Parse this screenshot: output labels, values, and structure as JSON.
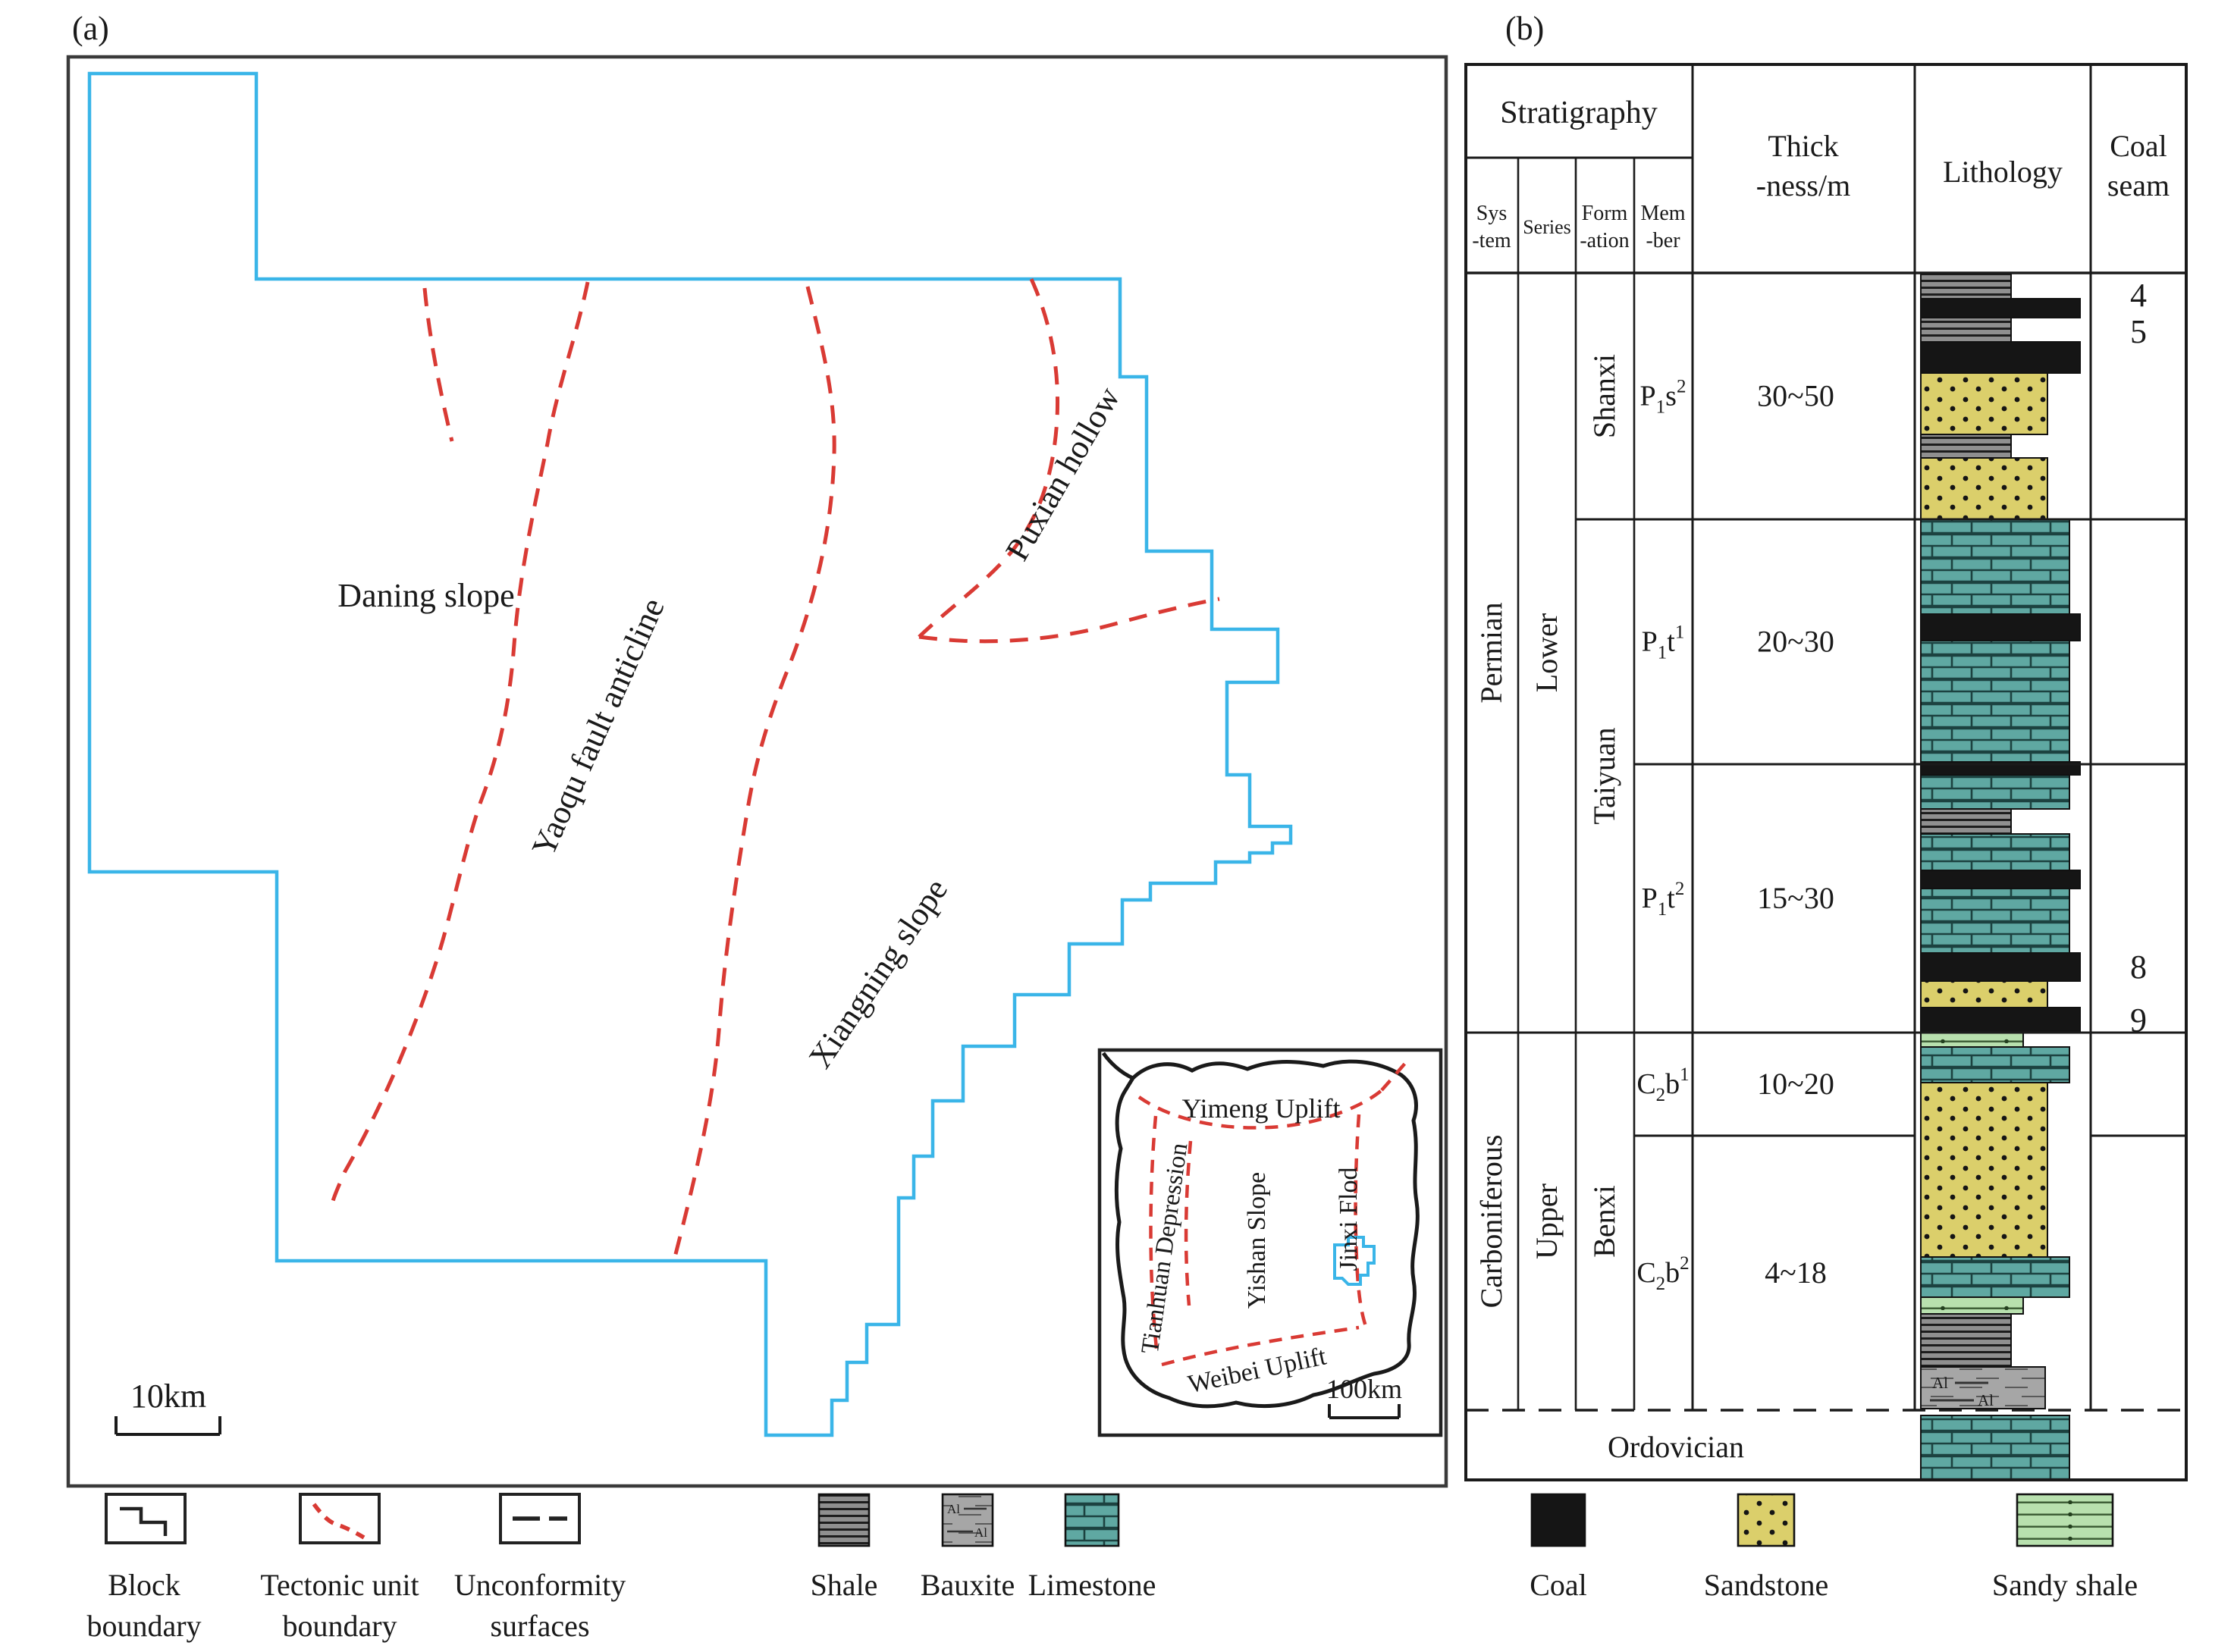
{
  "colors": {
    "block_boundary_blue": "#3AB5E8",
    "tectonic_red": "#D93A34",
    "limestone_teal": "#5FA8A2",
    "sandstone_yellow": "#DBCF6B",
    "sandy_shale_green": "#B8E0AE",
    "bauxite_gray": "#A6A6A6",
    "shale_gray": "#8F8F8F",
    "coal_black": "#151515",
    "line_black": "#1A1A1A"
  },
  "panel_a": {
    "label": "(a)",
    "region_labels": [
      {
        "name": "daning-slope",
        "text": "Daning slope",
        "x": 562,
        "y": 800,
        "rotate": 0,
        "size": 44
      },
      {
        "name": "yaoqu-fault-anticline",
        "text": "Yaoqu fault anticline",
        "x": 802,
        "y": 965,
        "rotate": -66,
        "size": 44
      },
      {
        "name": "puxian-hollow",
        "text": "Puxian hollow",
        "x": 1414,
        "y": 632,
        "rotate": -60,
        "size": 44
      },
      {
        "name": "xiangning-slope",
        "text": "Xiangning slope",
        "x": 1170,
        "y": 1292,
        "rotate": -56,
        "size": 44
      }
    ],
    "scale_bar": {
      "label": "10km"
    },
    "inset": {
      "labels": [
        {
          "name": "yimeng-uplift",
          "text": "Yimeng Uplift",
          "x": 1663,
          "y": 1474,
          "rotate": 0,
          "size": 36
        },
        {
          "name": "tianhuan-depression",
          "text": "Tianhuan Depression",
          "x": 1546,
          "y": 1648,
          "rotate": -82,
          "size": 33
        },
        {
          "name": "yishan-slope",
          "text": "Yishan Slope",
          "x": 1668,
          "y": 1636,
          "rotate": -90,
          "size": 34
        },
        {
          "name": "jinxi-flod",
          "text": "Jinxi Flod",
          "x": 1789,
          "y": 1608,
          "rotate": -90,
          "size": 34
        },
        {
          "name": "weibei-uplift",
          "text": "Weibei Uplift",
          "x": 1660,
          "y": 1818,
          "rotate": -12,
          "size": 34
        }
      ],
      "scale_label": "100km"
    }
  },
  "panel_b": {
    "label": "(b)",
    "header": {
      "stratigraphy": "Stratigraphy",
      "system": [
        "Sys",
        "-tem"
      ],
      "series": "Series",
      "formation": [
        "Form",
        "-ation"
      ],
      "member": [
        "Mem",
        "-ber"
      ],
      "thickness": [
        "Thick",
        "-ness/m"
      ],
      "lithology": "Lithology",
      "coal_seam": [
        "Coal",
        "seam"
      ]
    },
    "systems": [
      {
        "label": "Permian",
        "y0": 360,
        "y1": 1362
      },
      {
        "label": "Carboniferous",
        "y0": 1362,
        "y1": 1860
      }
    ],
    "series": [
      {
        "label": "Lower",
        "y0": 360,
        "y1": 1362
      },
      {
        "label": "Upper",
        "y0": 1362,
        "y1": 1860
      }
    ],
    "formations": [
      {
        "label": "Shanxi",
        "y0": 360,
        "y1": 685
      },
      {
        "label": "Taiyuan",
        "y0": 685,
        "y1": 1362
      },
      {
        "label": "Benxi",
        "y0": 1362,
        "y1": 1860
      }
    ],
    "members": [
      {
        "parts": [
          "P",
          "1",
          "s",
          "2"
        ],
        "thickness": "30~50",
        "y0": 360,
        "y1": 685
      },
      {
        "parts": [
          "P",
          "1",
          "t",
          "1"
        ],
        "thickness": "20~30",
        "y0": 685,
        "y1": 1008
      },
      {
        "parts": [
          "P",
          "1",
          "t",
          "2"
        ],
        "thickness": "15~30",
        "y0": 1008,
        "y1": 1362
      },
      {
        "parts": [
          "C",
          "2",
          "b",
          "1"
        ],
        "thickness": "10~20",
        "y0": 1362,
        "y1": 1498
      },
      {
        "parts": [
          "C",
          "2",
          "b",
          "2"
        ],
        "thickness": "4~18",
        "y0": 1498,
        "y1": 1860
      }
    ],
    "ordovician": "Ordovician",
    "bauxite_marker": "Al",
    "coal_seams": [
      {
        "label": "4",
        "y": 404
      },
      {
        "label": "5",
        "y": 452
      },
      {
        "label": "8",
        "y": 1290
      },
      {
        "label": "9",
        "y": 1360
      }
    ],
    "lithology_layers": [
      {
        "type": "shale",
        "y0": 360,
        "y1": 394
      },
      {
        "type": "coal",
        "y0": 394,
        "y1": 419
      },
      {
        "type": "shale",
        "y0": 419,
        "y1": 451
      },
      {
        "type": "coal",
        "y0": 451,
        "y1": 492
      },
      {
        "type": "sandstone",
        "y0": 492,
        "y1": 573
      },
      {
        "type": "shale",
        "y0": 573,
        "y1": 604
      },
      {
        "type": "sandstone",
        "y0": 604,
        "y1": 685
      },
      {
        "type": "limestone",
        "y0": 685,
        "y1": 810
      },
      {
        "type": "coal",
        "y0": 810,
        "y1": 845
      },
      {
        "type": "limestone",
        "y0": 845,
        "y1": 1005
      },
      {
        "type": "coal",
        "y0": 1005,
        "y1": 1022
      },
      {
        "type": "limestone",
        "y0": 1022,
        "y1": 1067
      },
      {
        "type": "shale",
        "y0": 1067,
        "y1": 1100
      },
      {
        "type": "limestone",
        "y0": 1100,
        "y1": 1148
      },
      {
        "type": "coal",
        "y0": 1148,
        "y1": 1172
      },
      {
        "type": "limestone",
        "y0": 1172,
        "y1": 1257
      },
      {
        "type": "coal",
        "y0": 1257,
        "y1": 1294
      },
      {
        "type": "sandstone",
        "y0": 1294,
        "y1": 1329
      },
      {
        "type": "coal",
        "y0": 1329,
        "y1": 1362
      },
      {
        "type": "sandy_shale",
        "y0": 1362,
        "y1": 1381
      },
      {
        "type": "limestone",
        "y0": 1381,
        "y1": 1428
      },
      {
        "type": "sandstone",
        "y0": 1428,
        "y1": 1658
      },
      {
        "type": "limestone",
        "y0": 1658,
        "y1": 1711
      },
      {
        "type": "sandy_shale",
        "y0": 1711,
        "y1": 1733
      },
      {
        "type": "shale",
        "y0": 1733,
        "y1": 1803
      },
      {
        "type": "bauxite",
        "y0": 1803,
        "y1": 1858
      },
      {
        "type": "limestone",
        "y0": 1867,
        "y1": 1952
      }
    ]
  },
  "legend": {
    "line_items": [
      {
        "name": "block-boundary",
        "lines": [
          "Block",
          "boundary"
        ],
        "x": 190
      },
      {
        "name": "tectonic-unit-boundary",
        "lines": [
          "Tectonic unit",
          "boundary"
        ],
        "x": 448
      },
      {
        "name": "unconformity-surfaces",
        "lines": [
          "Unconformity",
          "surfaces"
        ],
        "x": 712
      }
    ],
    "pattern_items": [
      {
        "name": "shale",
        "label": "Shale",
        "type": "shale",
        "x": 1080,
        "w": 66
      },
      {
        "name": "bauxite",
        "label": "Bauxite",
        "type": "bauxite",
        "x": 1243,
        "w": 66
      },
      {
        "name": "limestone",
        "label": "Limestone",
        "type": "limestone",
        "x": 1405,
        "w": 70
      },
      {
        "name": "coal",
        "label": "Coal",
        "type": "coal",
        "x": 2020,
        "w": 70
      },
      {
        "name": "sandstone",
        "label": "Sandstone",
        "type": "sandstone",
        "x": 2292,
        "w": 74
      },
      {
        "name": "sandy-shale",
        "label": "Sandy shale",
        "type": "sandy_shale",
        "x": 2660,
        "w": 126
      }
    ]
  }
}
